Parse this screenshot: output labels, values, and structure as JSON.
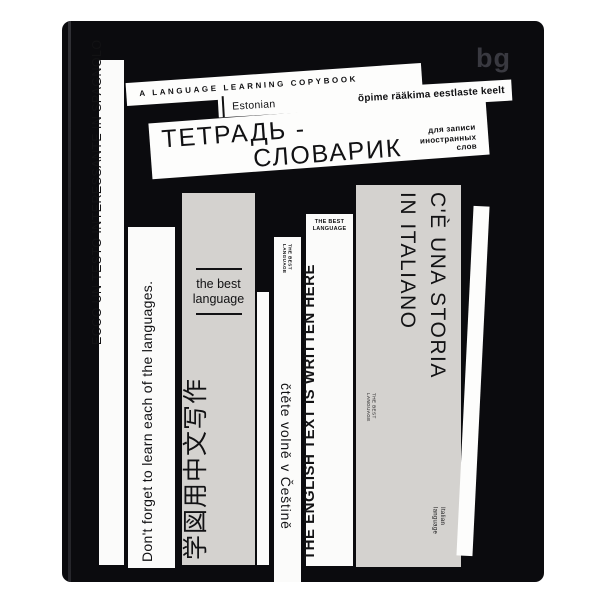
{
  "product": {
    "brand_logo": "bg",
    "header": {
      "tagline": "A LANGUAGE LEARNING COPYBOOK",
      "language_tab": "Estonian",
      "estonian_phrase": "õpime rääkima eestlaste keelt",
      "title_line1": "ТЕТРАДЬ -",
      "title_line2": "СЛОВАРИК",
      "subtitle_line1": "для записи",
      "subtitle_line2": "иностранных",
      "subtitle_line3": "слов"
    },
    "spines": {
      "spanish_strip_text": "ECCO UN TESTO INTERESSANTE IN SPAGNOLO",
      "reminder_text": "Don't forget to learn each of the languages.",
      "chinese": {
        "badge_line1": "the best",
        "badge_line2": "language",
        "text": "学図用中文写作"
      },
      "czech": {
        "badge_line1": "THE BEST",
        "badge_line2": "LANGUAGE",
        "text": "čtěte volně v Češtině"
      },
      "english": {
        "badge_line1": "THE BEST",
        "badge_line2": "LANGUAGE",
        "text": "THE ENGLISH TEXT IS WRITTEN HERE"
      },
      "italian": {
        "text_line1": "C'È UNA STORIA",
        "text_line2": "IN ITALIANO",
        "badge_line1": "THE BEST",
        "badge_line2": "LANGUAGE",
        "footer_line1": "Italian",
        "footer_line2": "language"
      }
    },
    "colors": {
      "cover": "#0b0b0e",
      "spine_gray": "#d4d2cf",
      "spine_white": "#fbfbfa",
      "logo_gray": "#393940",
      "text": "#121214"
    }
  }
}
